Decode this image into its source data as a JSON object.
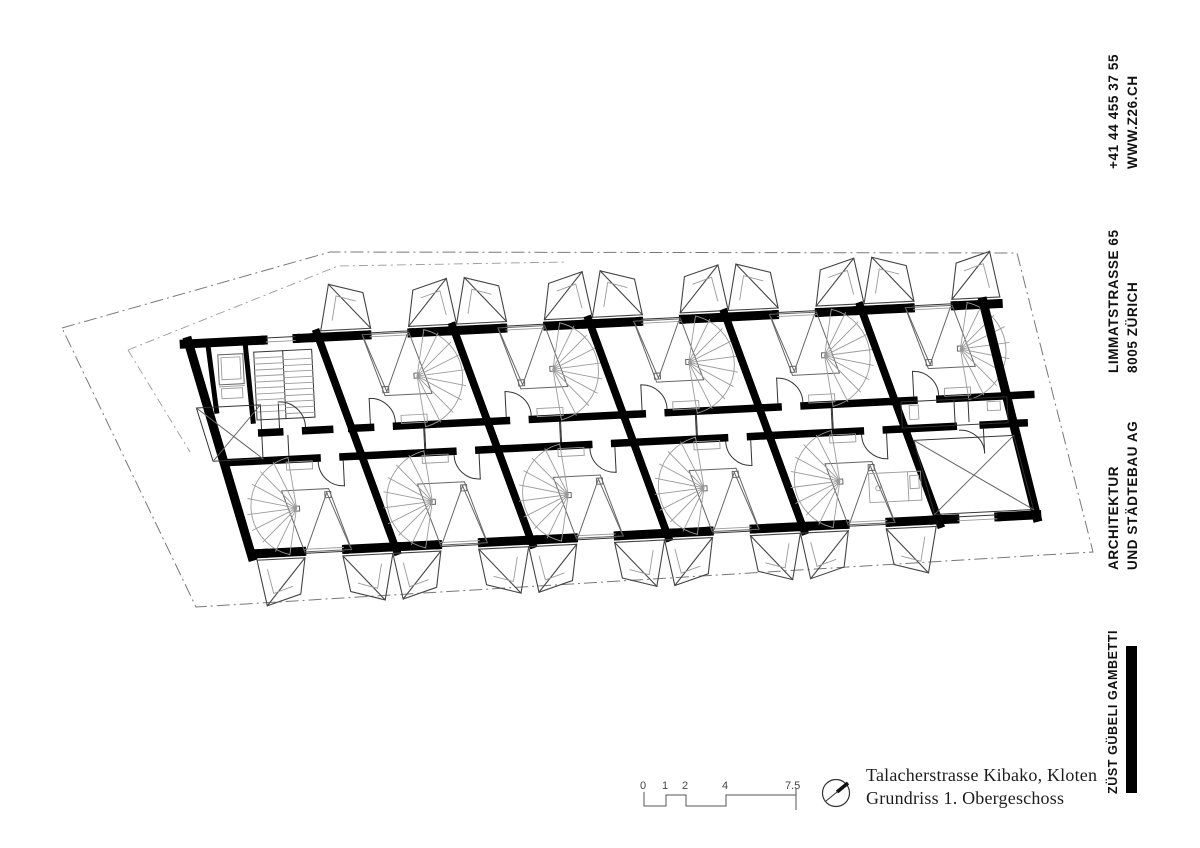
{
  "sidebar": {
    "contact_phone": "+41 44 455 37 55",
    "contact_web": "WWW.Z26.CH",
    "address_street": "LIMMATSTRASSE 65",
    "address_city": "8005 ZÜRICH",
    "firm_line1": "ARCHITEKTUR",
    "firm_line2": "UND STÄDTEBAU AG",
    "firm_name": "ZÜST GÜBELI GAMBETTI"
  },
  "title_block": {
    "project": "Talacherstrasse Kibako, Kloten",
    "drawing": "Grundriss 1. Obergeschoss"
  },
  "scale_bar": {
    "labels": [
      "0",
      "1",
      "2",
      "4",
      "7.5"
    ]
  },
  "icons": {
    "north_arrow": "compass-needle",
    "brand_bar": "black-bar"
  },
  "colors": {
    "ink": "#000000",
    "line": "#444444",
    "light": "#9a9a9a",
    "background": "#ffffff"
  }
}
